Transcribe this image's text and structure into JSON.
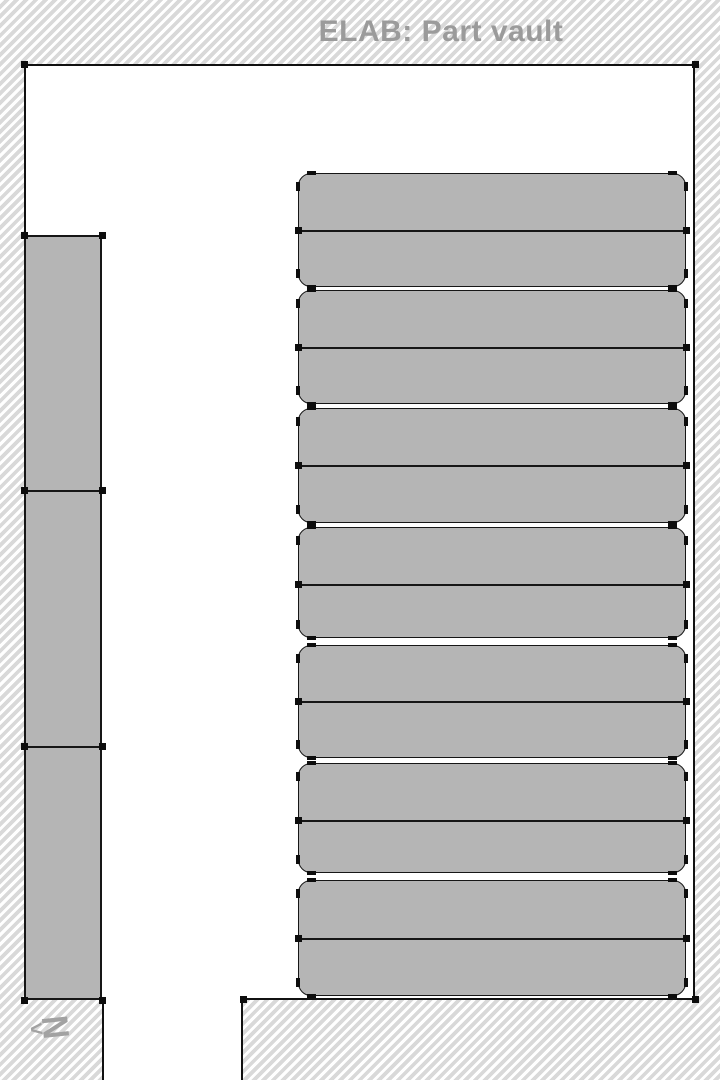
{
  "header": {
    "title": "ELAB: Part vault"
  },
  "north": {
    "label": "N",
    "arrow": "<"
  },
  "colors": {
    "floor": "#ffffff",
    "hatch_stripe": "#d9d9d9",
    "wall_line": "#111111",
    "shelf_fill": "#b5b5b5",
    "shelf_outline": "#161616",
    "handle": "#0d0d0d",
    "title_text": "#9b9b9b",
    "north_symbol": "#a2a2a2"
  },
  "plan": {
    "room": {
      "left": 24,
      "top": 64,
      "right": 695,
      "bottom": 1000
    },
    "corridor": {
      "left": 102,
      "right": 243,
      "top": 1000,
      "bottom": 1080
    },
    "south_wall_line": {
      "y": 998,
      "x1": 243,
      "x2": 696
    },
    "wall_shelf_stack": {
      "left": 24,
      "top": 235,
      "right": 102,
      "bottom": 1000,
      "dividers": [
        490,
        746
      ]
    },
    "shelf_units": {
      "left": 298,
      "right": 686,
      "corner_radius": 13,
      "rows": [
        {
          "top": 173,
          "bottom": 287,
          "divider": 230
        },
        {
          "top": 290,
          "bottom": 404,
          "divider": 347
        },
        {
          "top": 408,
          "bottom": 523,
          "divider": 465
        },
        {
          "top": 527,
          "bottom": 638,
          "divider": 584
        },
        {
          "top": 645,
          "bottom": 758,
          "divider": 701
        },
        {
          "top": 763,
          "bottom": 873,
          "divider": 820
        },
        {
          "top": 880,
          "bottom": 996,
          "divider": 938
        }
      ]
    },
    "wall_vertex_handles": [
      [
        24,
        64
      ],
      [
        695,
        64
      ],
      [
        695,
        999
      ],
      [
        243,
        999
      ]
    ]
  }
}
